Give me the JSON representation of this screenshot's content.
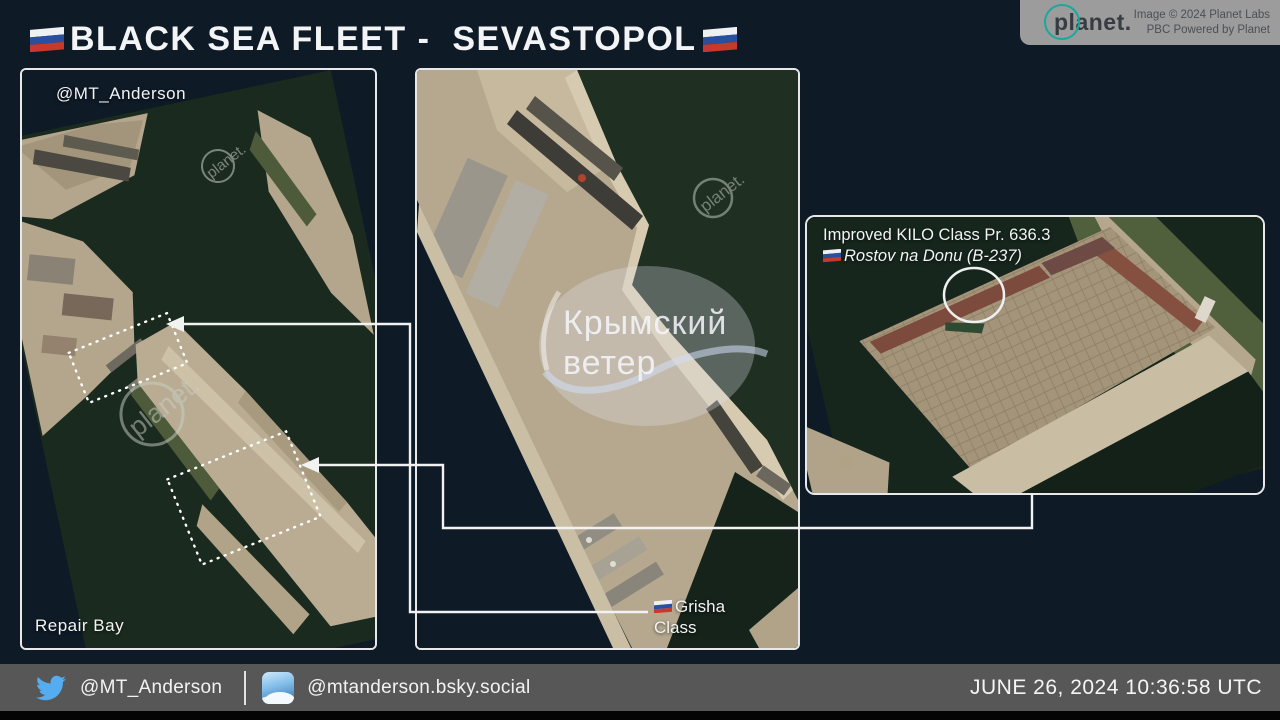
{
  "header": {
    "title": "BLACK SEA FLEET -  SEVASTOPOL",
    "planet_attribution": {
      "logo": "planet.",
      "line1": "Image © 2024 Planet Labs",
      "line2": "PBC Powered by Planet"
    }
  },
  "panels": {
    "left": {
      "credit": "@MT_Anderson",
      "caption": "Repair Bay",
      "watermark": "planet."
    },
    "middle": {
      "watermark": {
        "line1": "Крымский",
        "line2": "ветер"
      },
      "planet_watermark": "planet.",
      "ship_label": {
        "line1": "Grisha",
        "line2": "Class"
      }
    },
    "right": {
      "label": {
        "line1": "Improved KILO Class Pr. 636.3",
        "line2": "Rostov na Donu (B-237)"
      }
    }
  },
  "footer": {
    "twitter_handle": "@MT_Anderson",
    "bluesky_handle": "@mtanderson.bsky.social",
    "timestamp": "JUNE 26, 2024 10:36:58 UTC"
  },
  "colors": {
    "background": "#0e1a26",
    "panel_border": "#e8e8e8",
    "water": "#1c2b1f",
    "land": "#b7aa90",
    "planet_teal": "#17a99c",
    "twitter_blue": "#55acee",
    "footer_bar": "#575757"
  }
}
